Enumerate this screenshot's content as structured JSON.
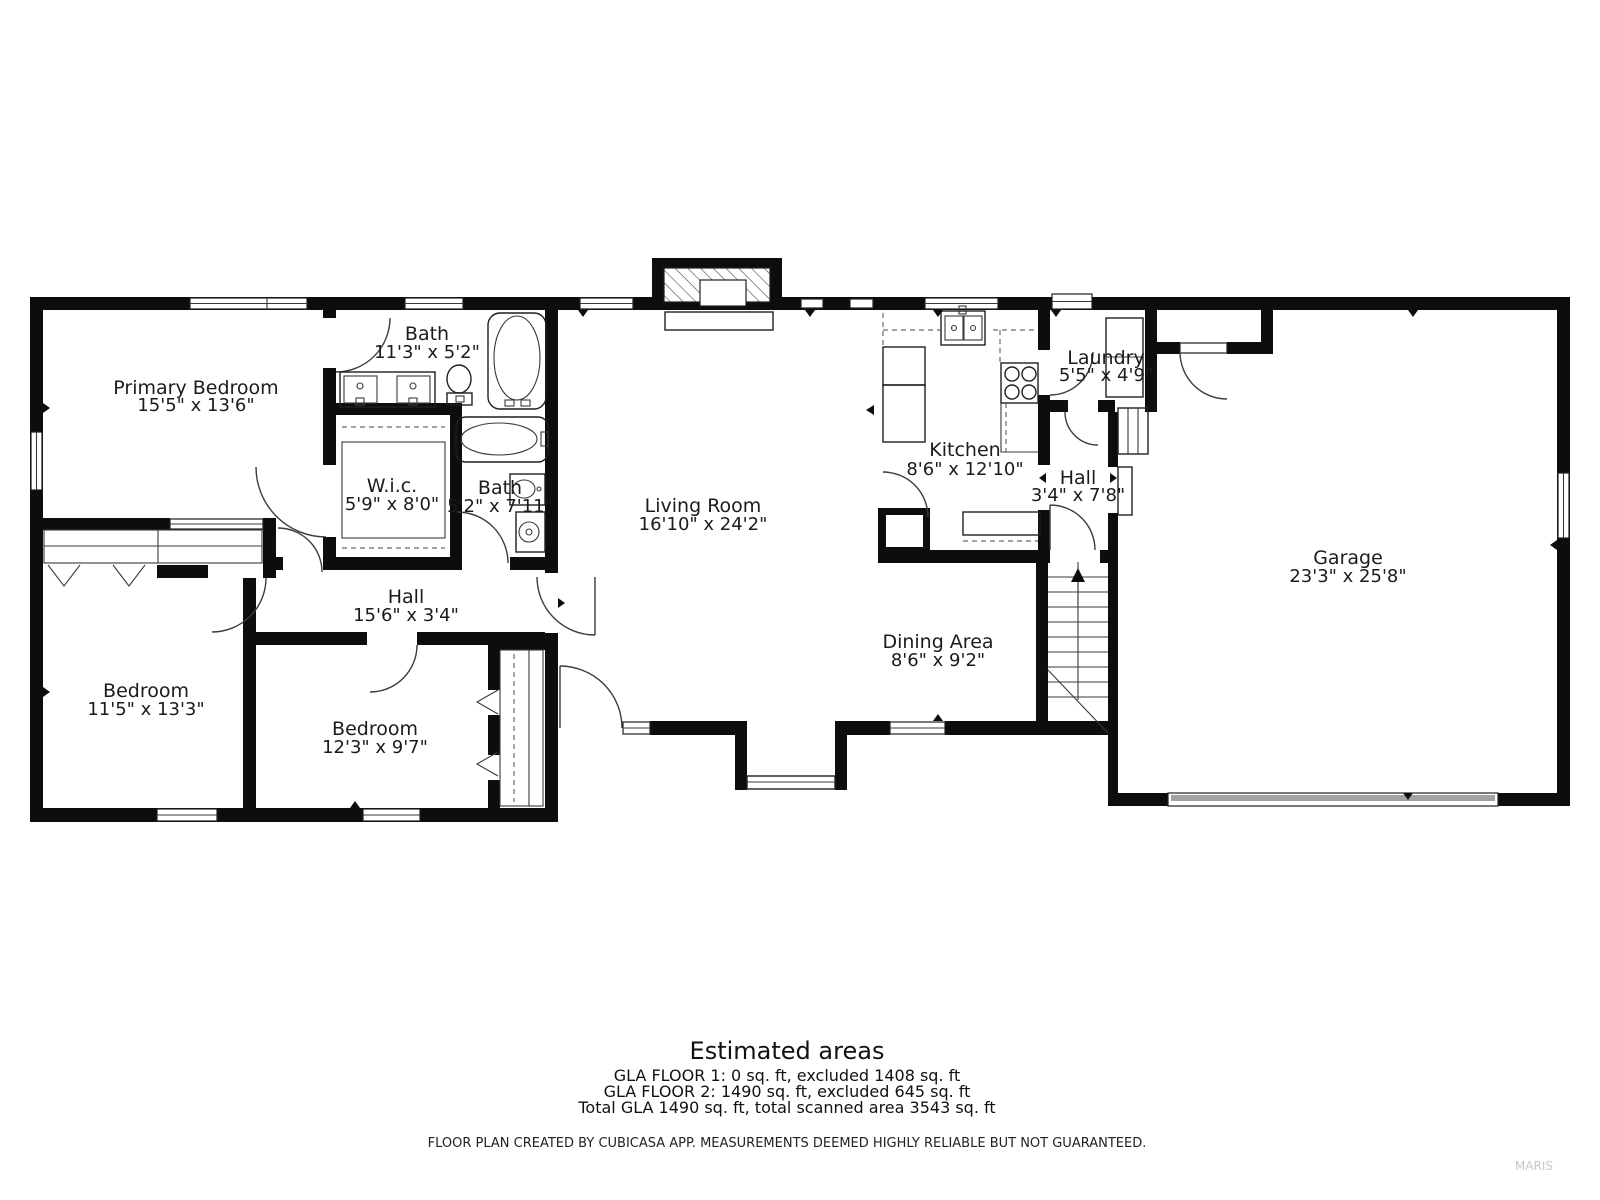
{
  "rooms": {
    "primary_bedroom": {
      "name": "Primary Bedroom",
      "dims": "15'5\" x 13'6\""
    },
    "bath_top": {
      "name": "Bath",
      "dims": "11'3\" x 5'2\""
    },
    "wic": {
      "name": "W.i.c.",
      "dims": "5'9\" x 8'0\""
    },
    "bath_small": {
      "name": "Bath",
      "dims": "5'2\" x 7'11\""
    },
    "living_room": {
      "name": "Living Room",
      "dims": "16'10\" x 24'2\""
    },
    "kitchen": {
      "name": "Kitchen",
      "dims": "8'6\" x 12'10\""
    },
    "laundry": {
      "name": "Laundry",
      "dims": "5'5\" x 4'9\""
    },
    "hall_right": {
      "name": "Hall",
      "dims": "3'4\" x 7'8\""
    },
    "garage": {
      "name": "Garage",
      "dims": "23'3\" x 25'8\""
    },
    "hall_left": {
      "name": "Hall",
      "dims": "15'6\" x 3'4\""
    },
    "bedroom_left": {
      "name": "Bedroom",
      "dims": "11'5\" x 13'3\""
    },
    "bedroom_mid": {
      "name": "Bedroom",
      "dims": "12'3\" x 9'7\""
    },
    "dining": {
      "name": "Dining Area",
      "dims": "8'6\" x 9'2\""
    }
  },
  "summary": {
    "title": "Estimated areas",
    "line1": "GLA FLOOR 1: 0 sq. ft, excluded 1408 sq. ft",
    "line2": "GLA FLOOR 2: 1490 sq. ft, excluded 645 sq. ft",
    "line3": "Total GLA 1490 sq. ft, total scanned area 3543 sq. ft"
  },
  "footer": {
    "disclaimer": "FLOOR PLAN CREATED BY CUBICASA APP. MEASUREMENTS DEEMED HIGHLY RELIABLE BUT NOT GUARANTEED.",
    "watermark": "MARIS"
  },
  "colors": {
    "wall": "#0d0d0d",
    "garage_door": "#a3a3a3",
    "watermark_gray": "#c8c8c8"
  }
}
